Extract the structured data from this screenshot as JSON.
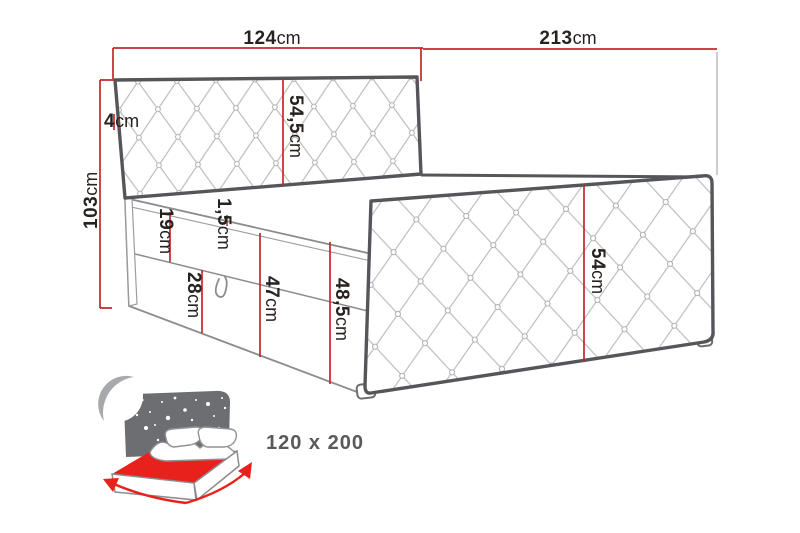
{
  "diagram": {
    "title_hint": "bed dimension drawing",
    "unit": "cm",
    "dimensions": {
      "width_top": {
        "value": "124",
        "unit": "cm"
      },
      "length_top": {
        "value": "213",
        "unit": "cm"
      },
      "headboard_edge": {
        "value": "4",
        "unit": "cm"
      },
      "height_total": {
        "value": "103",
        "unit": "cm"
      },
      "headboard_panel": {
        "value": "54,5",
        "unit": "cm"
      },
      "topper_seam": {
        "value": "1,5",
        "unit": "cm"
      },
      "mattress_band": {
        "value": "19",
        "unit": "cm"
      },
      "storage_box": {
        "value": "28",
        "unit": "cm"
      },
      "base_height": {
        "value": "47",
        "unit": "cm"
      },
      "base_height_full": {
        "value": "48,5",
        "unit": "cm"
      },
      "footboard": {
        "value": "54",
        "unit": "cm"
      }
    },
    "size_label": "120 x 200",
    "colors": {
      "dimension_line": "#c4272b",
      "outline_dark": "#55565a",
      "outline_mid": "#8a8c8f",
      "tufting_line": "#b6b8ba",
      "icon_gray": "#6d6e71",
      "icon_red": "#e8211d",
      "size_text": "#58595b",
      "label_text": "#27221f"
    }
  }
}
